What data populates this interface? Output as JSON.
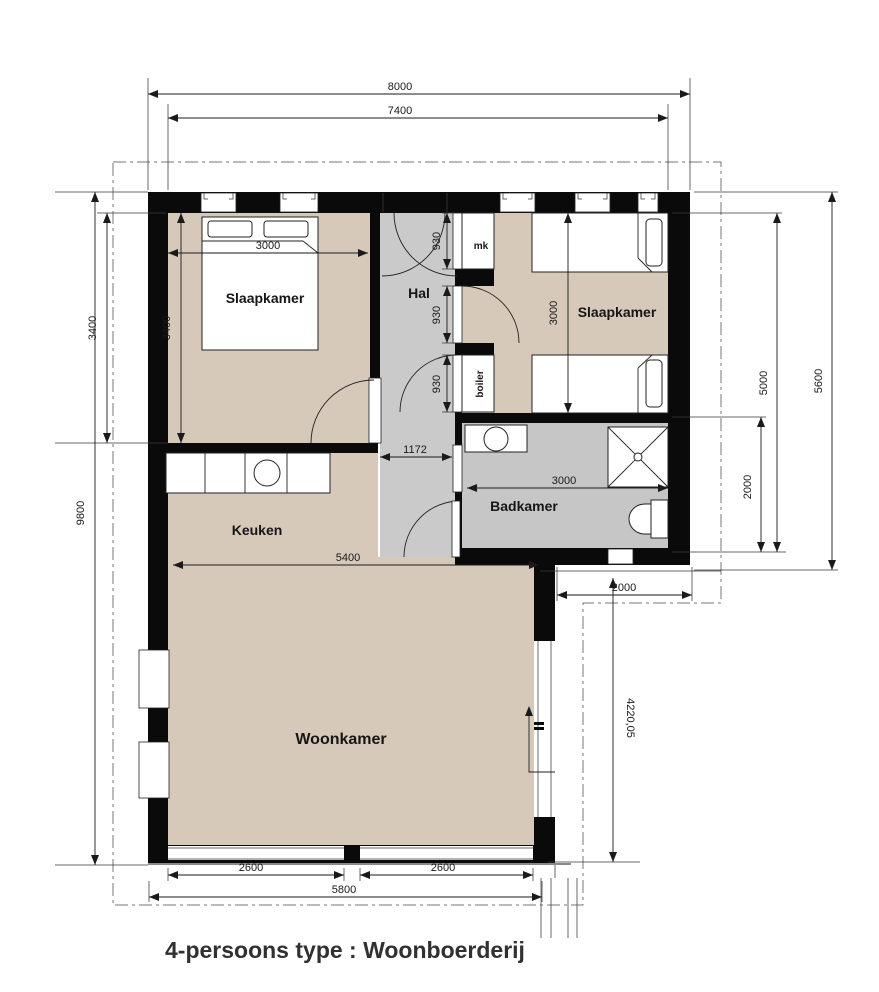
{
  "title": "4-persoons type : Woonboerderij",
  "rooms": {
    "bedroom_left": "Slaapkamer",
    "bedroom_right": "Slaapkamer",
    "hall": "Hal",
    "bathroom": "Badkamer",
    "kitchen": "Keuken",
    "living": "Woonkamer"
  },
  "closets": {
    "meter_cupboard": "mk",
    "boiler": "boiler"
  },
  "dimensions": {
    "top_outer": "8000",
    "top_inner": "7400",
    "left_total_height": "9800",
    "left_bedroom_height_outer": "3400",
    "bedroom_left_height": "3400",
    "bedroom_left_width": "3000",
    "hall_door_top": "930",
    "hall_door_middle": "930",
    "hall_door_bottom": "930",
    "hall_width": "1172",
    "bedroom_right_height": "3000",
    "bathroom_width": "3000",
    "bathroom_height": "2000",
    "right_inner_height": "5000",
    "right_outer_height": "5600",
    "kitchen_living_width": "5400",
    "rear_step_width": "2000",
    "living_right_height": "4220,05",
    "bottom_window_left": "2600",
    "bottom_window_right": "2600",
    "bottom_total": "5800"
  },
  "colors": {
    "floor_beige": "#d6c9ba",
    "floor_gray": "#cacaca",
    "wall_black": "#0a0a0a",
    "dimension_line": "#1a1a1a"
  }
}
